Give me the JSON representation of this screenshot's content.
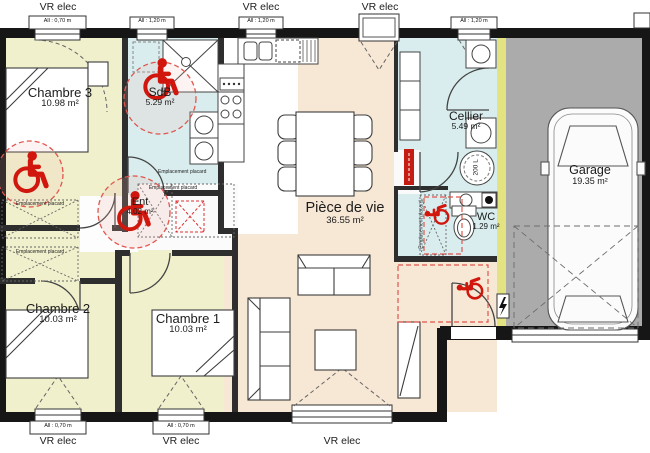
{
  "labels": {
    "vr_elec": "VR elec",
    "placard": "Emplacement placard",
    "water_heater": "200 L"
  },
  "windows": {
    "top_1": "All : 0,70 m",
    "top_2": "All : 1,20 m",
    "top_3": "All : 1,20 m",
    "top_4": "All : 1,20 m",
    "bottom_1": "All : 0,70 m",
    "bottom_2": "All : 0,70 m"
  },
  "rooms": {
    "chambre3": {
      "name": "Chambre 3",
      "area": "10.98 m²"
    },
    "sdb": {
      "name": "SdB",
      "area": "5.29 m²"
    },
    "ent": {
      "name": "Ent",
      "area": "4.02 m²"
    },
    "chambre2": {
      "name": "Chambre 2",
      "area": "10.03 m²"
    },
    "chambre1": {
      "name": "Chambre 1",
      "area": "10.03 m²"
    },
    "piece_de_vie": {
      "name": "Pièce de vie",
      "area": "36.55 m²"
    },
    "cellier": {
      "name": "Cellier",
      "area": "5.49 m²"
    },
    "wc": {
      "name": "WC",
      "area": "1.29 m²"
    },
    "garage": {
      "name": "Garage",
      "area": "19.35 m²"
    }
  },
  "colors": {
    "bedroom_floor": "#f0f0cd",
    "wet_room_floor": "#d9edee",
    "living_floor": "#f7e7d5",
    "garage_floor": "#ababab",
    "party_wall": "#e3e381",
    "wall": "#161616",
    "accessibility_red": "#d1170d"
  }
}
